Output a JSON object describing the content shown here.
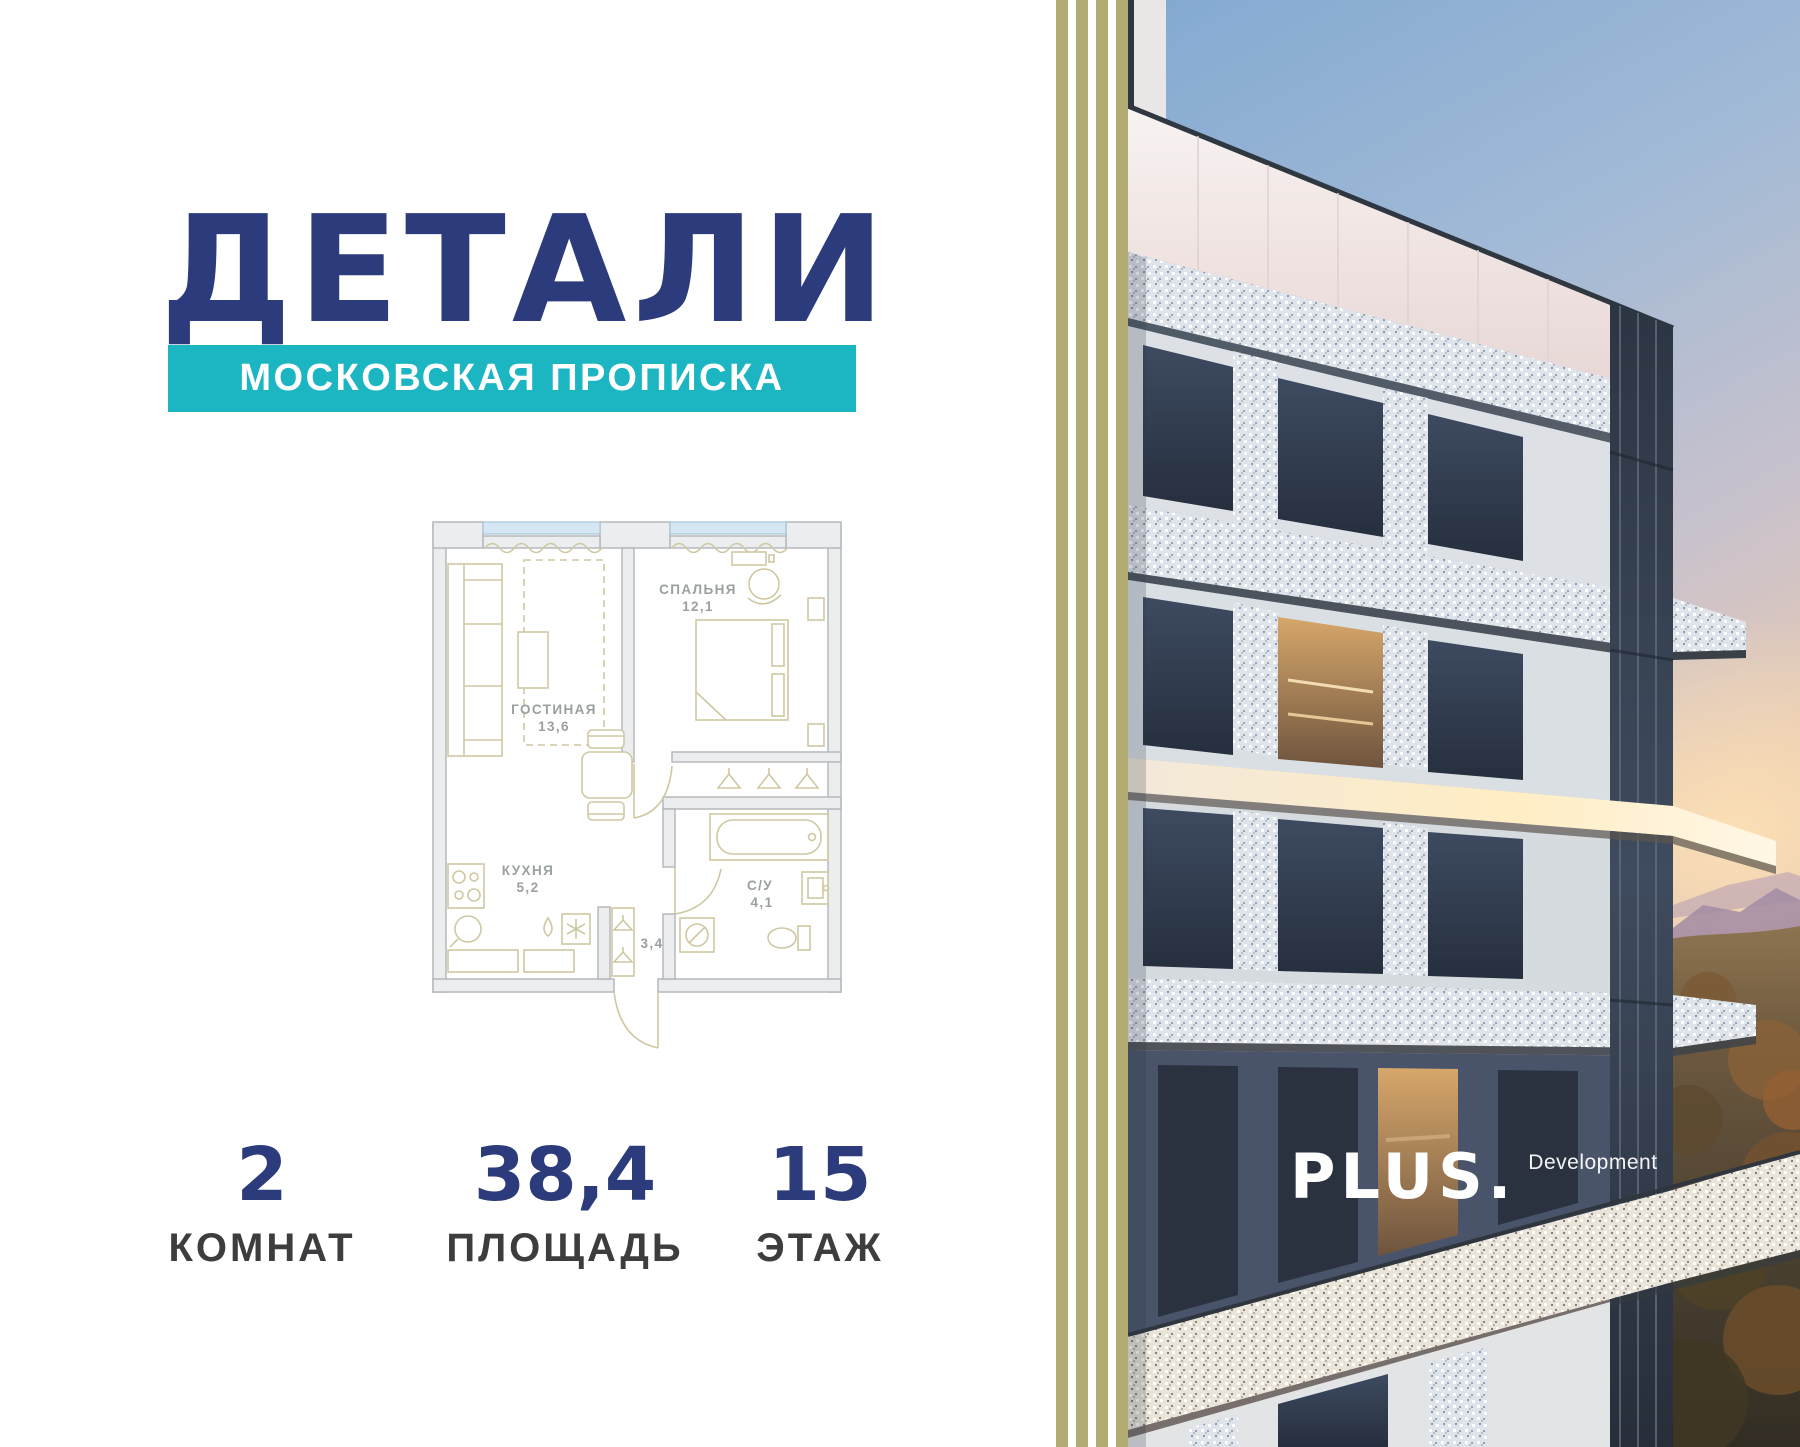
{
  "brand": {
    "logo": "ДЕТАЛИ",
    "tagline": "МОСКОВСКАЯ ПРОПИСКА"
  },
  "floorplan": {
    "rooms": [
      {
        "name": "ГОСТИНАЯ",
        "area": "13,6"
      },
      {
        "name": "СПАЛЬНЯ",
        "area": "12,1"
      },
      {
        "name": "КУХНЯ",
        "area": "5,2"
      },
      {
        "name": "С/У",
        "area": "4,1"
      },
      {
        "name": "",
        "area": "3,4"
      }
    ]
  },
  "stats": [
    {
      "value": "2",
      "label": "КОМНАТ"
    },
    {
      "value": "38,4",
      "label": "ПЛОЩАДЬ"
    },
    {
      "value": "15",
      "label": "ЭТАЖ"
    }
  ],
  "developer": {
    "name": "PLUS.",
    "suffix": "Development"
  },
  "colors": {
    "navy": "#2b3b7c",
    "teal": "#1bb6c1",
    "stripe": "#b2ac72",
    "plan_line": "#cfc8a2",
    "label_gray": "#9aa0a0",
    "label_dark": "#3d3d3f"
  }
}
